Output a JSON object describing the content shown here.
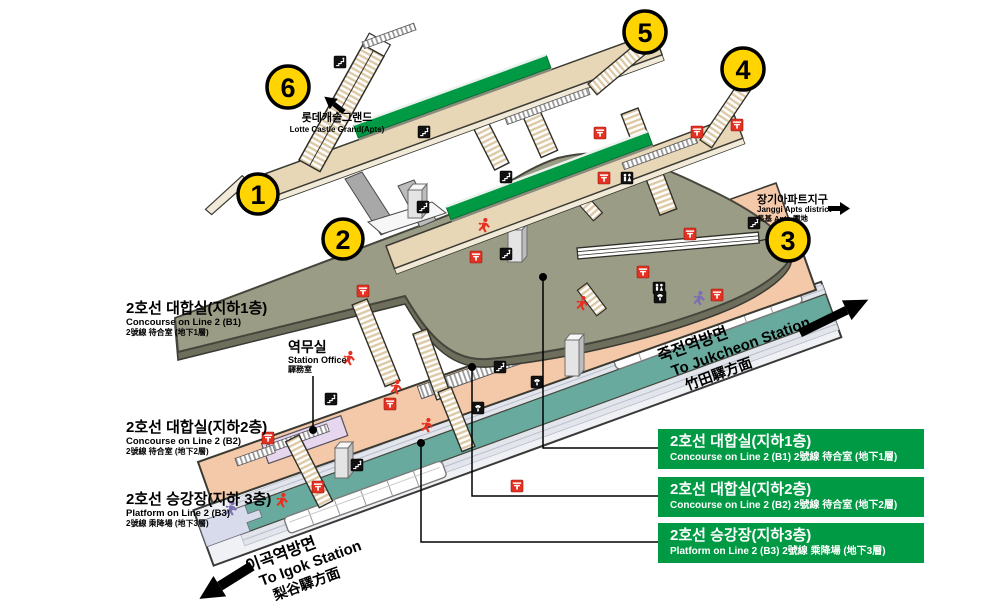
{
  "colors": {
    "line_green": "#009A44",
    "exit_yellow": "#FFD400",
    "icon_red": "#E53122",
    "level_b1": "#9B9C86",
    "level_b2": "#F4C9A9",
    "level_b3": "#68AA9E"
  },
  "exits": [
    {
      "number": "1"
    },
    {
      "number": "2"
    },
    {
      "number": "3"
    },
    {
      "number": "4"
    },
    {
      "number": "5"
    },
    {
      "number": "6"
    }
  ],
  "left_labels": [
    {
      "ko": "2호선 대합실(지하1층)",
      "en": "Concourse on Line 2 (B1)",
      "hanja": "2號線 待合室 (地下1層)"
    },
    {
      "ko": "2호선 대합실(지하2층)",
      "en": "Concourse on Line 2 (B2)",
      "hanja": "2號線 待合室 (地下2層)"
    },
    {
      "ko": "2호선 승강장(지하 3층)",
      "en": "Platform on Line 2 (B3)",
      "hanja": "2號線 乘降場 (地下3層)"
    }
  ],
  "legend": [
    {
      "ko": "2호선 대합실(지하1층)",
      "en": "Concourse on Line 2 (B1) 2號線 待合室 (地下1層)"
    },
    {
      "ko": "2호선 대합실(지하2층)",
      "en": "Concourse on Line 2 (B2) 2號線 待合室 (地下2層)"
    },
    {
      "ko": "2호선 승강장(지하3층)",
      "en": "Platform on Line 2 (B3) 2號線 乘降場 (地下3層)"
    }
  ],
  "station_office": {
    "ko": "역무실",
    "en": "Station Office",
    "hanja": "驛務室"
  },
  "destinations": {
    "jukcheon": {
      "ko": "죽전역방면",
      "en": "To Jukcheon Station",
      "hanja": "竹田驛方面"
    },
    "igok": {
      "ko": "이곡역방면",
      "en": "To Igok Station",
      "hanja": "梨谷驛方面"
    }
  },
  "landmarks": {
    "lotte": {
      "ko": "롯데캐슬그랜드",
      "en": "Lotte Castle Grand(Apts)"
    },
    "janggi": {
      "ko": "장기아파트지구",
      "en": "Janggi Apts district",
      "hanja": "長基 Apts 團地"
    }
  }
}
